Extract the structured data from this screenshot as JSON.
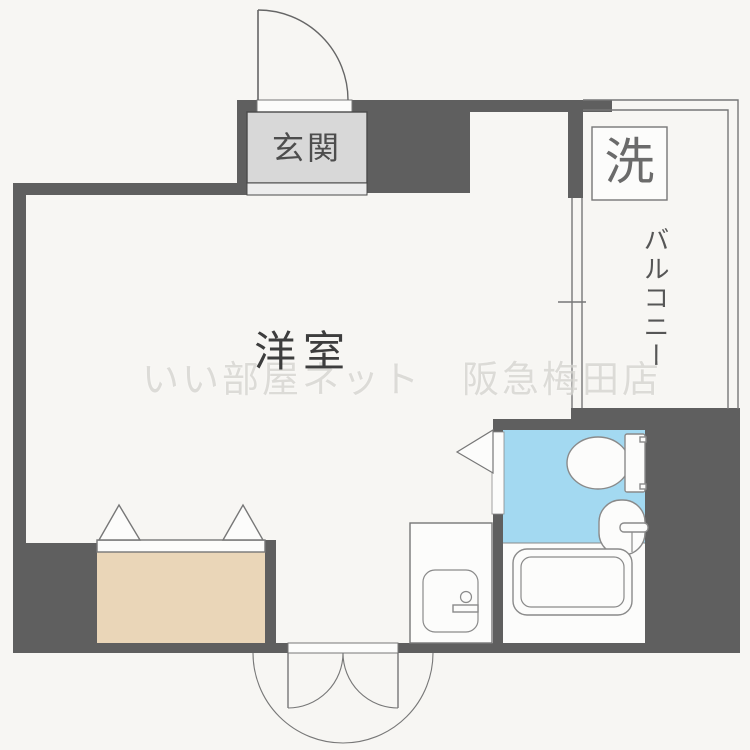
{
  "plan": {
    "labels": {
      "entrance": "玄関",
      "western_room": "洋室",
      "washing_machine": "洗",
      "balcony": "バルコニー"
    },
    "watermark": "いい部屋ネット　阪急梅田店"
  },
  "colors": {
    "paper": "#f7f6f3",
    "wall": "#5f5f5f",
    "genkan": "#d8d8d8",
    "genkan-step": "#ededed",
    "closet": "#ead6b8",
    "bath": "#a3d9f1",
    "white": "#fcfcfb",
    "line": "#777777",
    "fixline": "#8a8a8a",
    "watermark": "#d6d5d1"
  }
}
